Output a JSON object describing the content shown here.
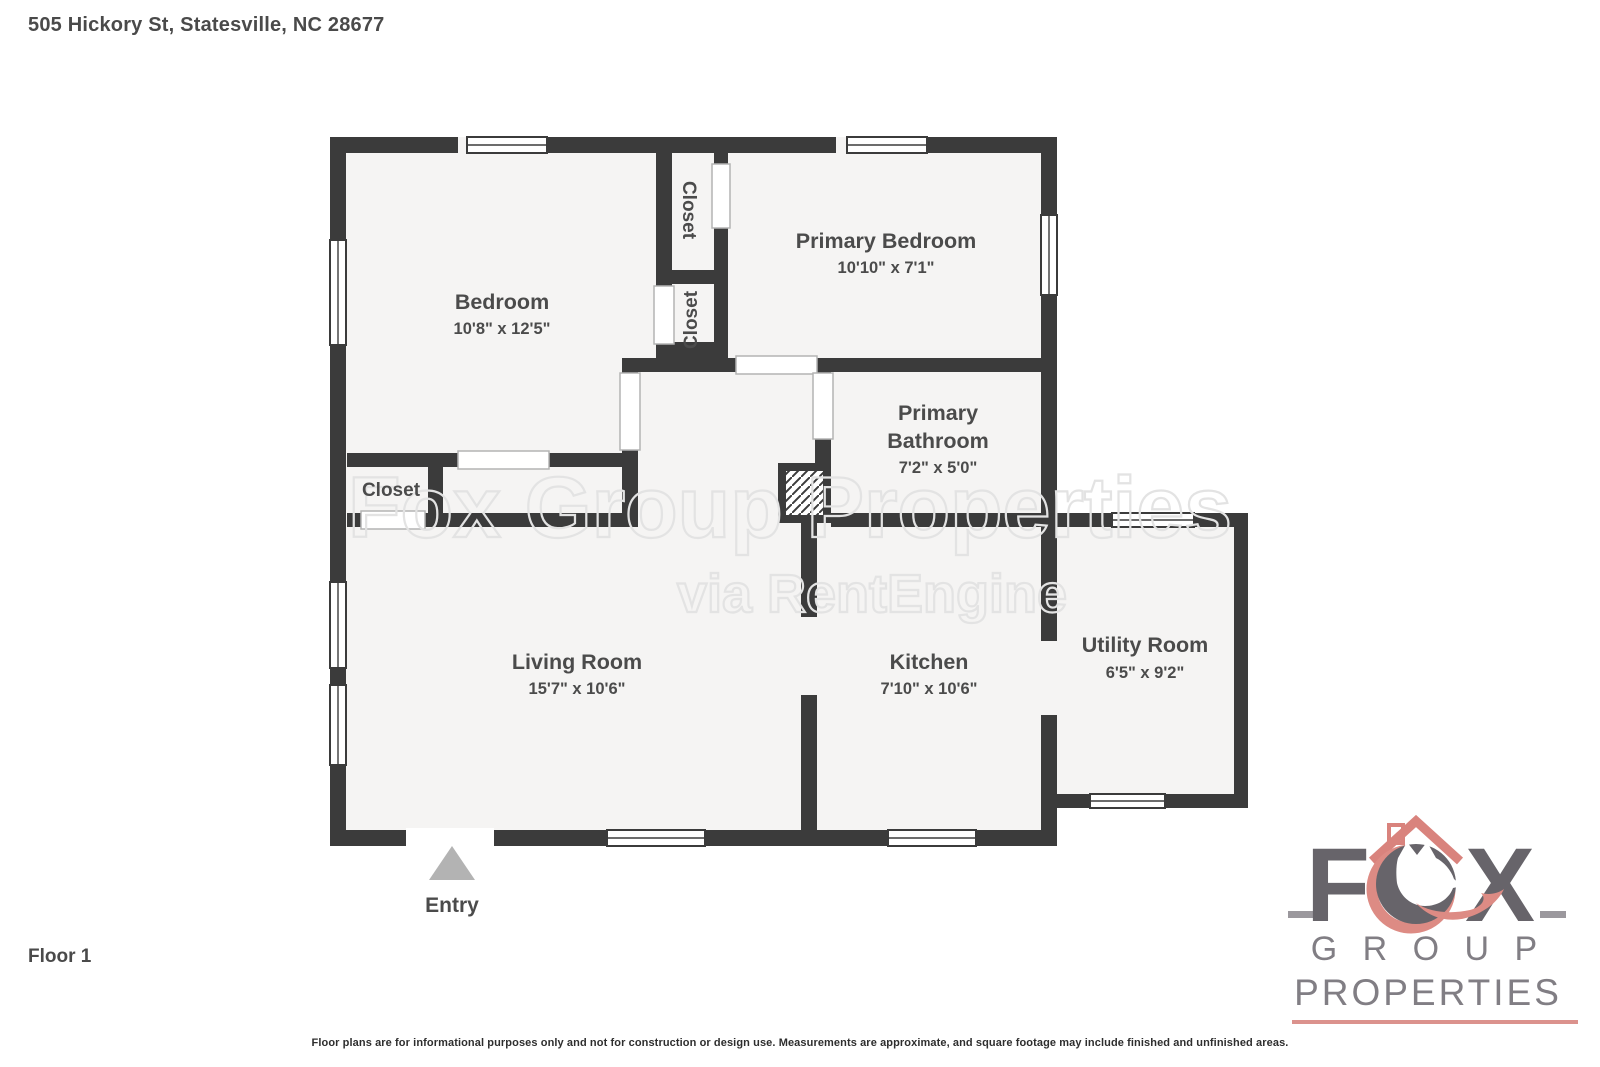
{
  "page": {
    "title": "505 Hickory St, Statesville, NC 28677",
    "floor_label": "Floor 1",
    "disclaimer": "Floor plans are for informational purposes only and not for construction or design use. Measurements are approximate, and square footage may include finished and unfinished areas."
  },
  "floorplan": {
    "rooms": [
      {
        "name": "Bedroom",
        "dims": "10'8\" x 12'5\""
      },
      {
        "name": "Primary Bedroom",
        "dims": "10'10\" x 7'1\""
      },
      {
        "name_line1": "Primary",
        "name_line2": "Bathroom",
        "dims": "7'2\" x 5'0\""
      },
      {
        "name": "Living Room",
        "dims": "15'7\" x 10'6\""
      },
      {
        "name": "Kitchen",
        "dims": "7'10\" x 10'6\""
      },
      {
        "name": "Utility Room",
        "dims": "6'5\" x 9'2\""
      }
    ],
    "closet_label": "Closet",
    "entry_label": "Entry"
  },
  "watermark": {
    "line1": "Fox Group Properties",
    "line2": "via RentEngine"
  },
  "logo": {
    "letter_f": "F",
    "letter_x": "X",
    "group": "G R O U P",
    "properties": "PROPERTIES"
  },
  "colors": {
    "wall": "#3b3b3b",
    "floor": "#f5f4f3",
    "label": "#4b4b4b",
    "watermark": "#e3e3e3",
    "logo_gray": "#67646a",
    "logo_salmon": "#dd8b84",
    "entry_triangle": "#b3b3b3"
  }
}
